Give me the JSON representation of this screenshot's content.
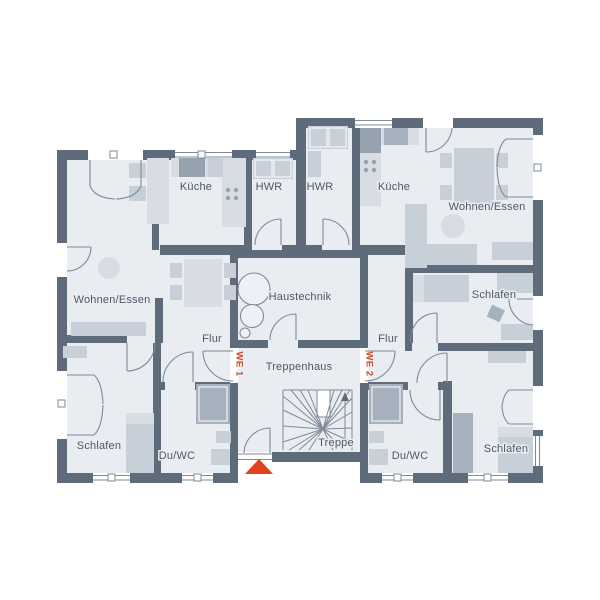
{
  "floor_plan": {
    "type": "architectural-floor-plan",
    "labels": {
      "kueche_we1": "Küche",
      "hwr_we1": "HWR",
      "hwr_we2": "HWR",
      "kueche_we2": "Küche",
      "wohnen_we1": "Wohnen/Essen",
      "wohnen_we2": "Wohnen/Essen",
      "haustechnik": "Haustechnik",
      "flur_we1": "Flur",
      "flur_we2": "Flur",
      "treppenhaus": "Treppenhaus",
      "treppe": "Treppe",
      "schlafen_we1": "Schlafen",
      "schlafen_mid_we2": "Schlafen",
      "schlafen_we2": "Schlafen",
      "duwc_we1": "Du/WC",
      "duwc_we2": "Du/WC",
      "we1": "WE 1",
      "we2": "WE 2"
    },
    "icons": {
      "entrance_marker": "triangle-up-icon",
      "stair_direction": "arrow-up-icon"
    },
    "colors": {
      "wall": "#5e6b7a",
      "floor": "#e9edf2",
      "furniture": "#c7cfd8",
      "furniture_light": "#d8dde4",
      "furniture_dark": "#a7b0bd",
      "appliance": "#97a2af",
      "line": "#7f8997",
      "label_text": "#4d5866",
      "unit_text": "#c8502a",
      "entrance_marker": "#e2421b"
    }
  }
}
